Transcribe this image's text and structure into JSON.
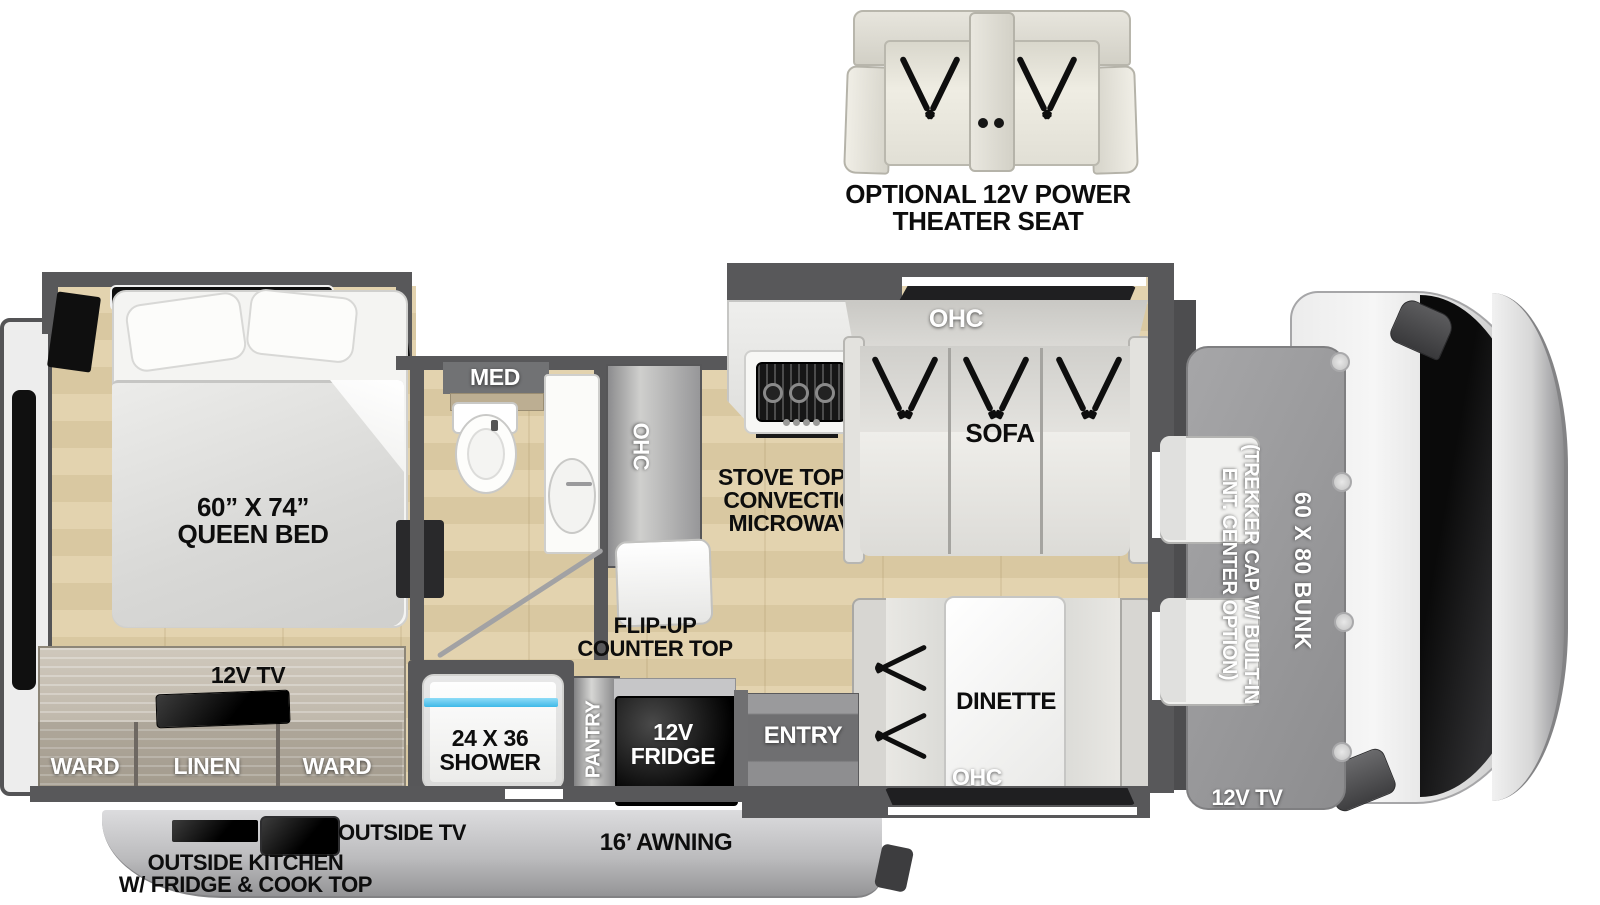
{
  "palette": {
    "wall": "#58585a",
    "floor_wood": "#ddcca6",
    "cabinet_wood": "#b9b1a4",
    "appliance_black": "#111111",
    "exterior_skirt": "#c2c2c4",
    "bunk_overlay": "#9a9a9c",
    "shower_glass_cyan": "#5ec9ef",
    "label_black": "#0d0d0d",
    "label_white": "#ffffff"
  },
  "optional_seat": {
    "line1": "OPTIONAL 12V POWER",
    "line2": "THEATER SEAT"
  },
  "bedroom": {
    "bed_line1": "60” X 74”",
    "bed_line2": "QUEEN BED",
    "tv": "12V TV",
    "ward_left": "WARD",
    "linen": "LINEN",
    "ward_right": "WARD"
  },
  "bathroom": {
    "med": "MED"
  },
  "kitchen": {
    "ohc": "OHC",
    "flip_line1": "FLIP-UP",
    "flip_line2": "COUNTER TOP",
    "stove_line1": "STOVE TOP W/",
    "stove_line2": "CONVECTION",
    "stove_line3": "MICROWAVE",
    "pantry": "PANTRY",
    "fridge_line1": "12V",
    "fridge_line2": "FRIDGE"
  },
  "living": {
    "sofa_ohc": "OHC",
    "sofa": "SOFA",
    "dinette": "DINETTE",
    "dinette_ohc": "OHC",
    "entry": "ENTRY"
  },
  "shower": {
    "line1": "24 X 36",
    "line2": "SHOWER"
  },
  "cab": {
    "bunk": "60 X 80 BUNK",
    "trekker_line1": "(TREKKER CAP W/ BUILT-IN",
    "trekker_line2": "ENT. CENTER OPTION)",
    "tv": "12V TV"
  },
  "exterior": {
    "outside_tv": "OUTSIDE TV",
    "outside_kitchen_line1": "OUTSIDE KITCHEN",
    "outside_kitchen_line2": "W/ FRIDGE & COOK TOP",
    "awning": "16’ AWNING"
  }
}
